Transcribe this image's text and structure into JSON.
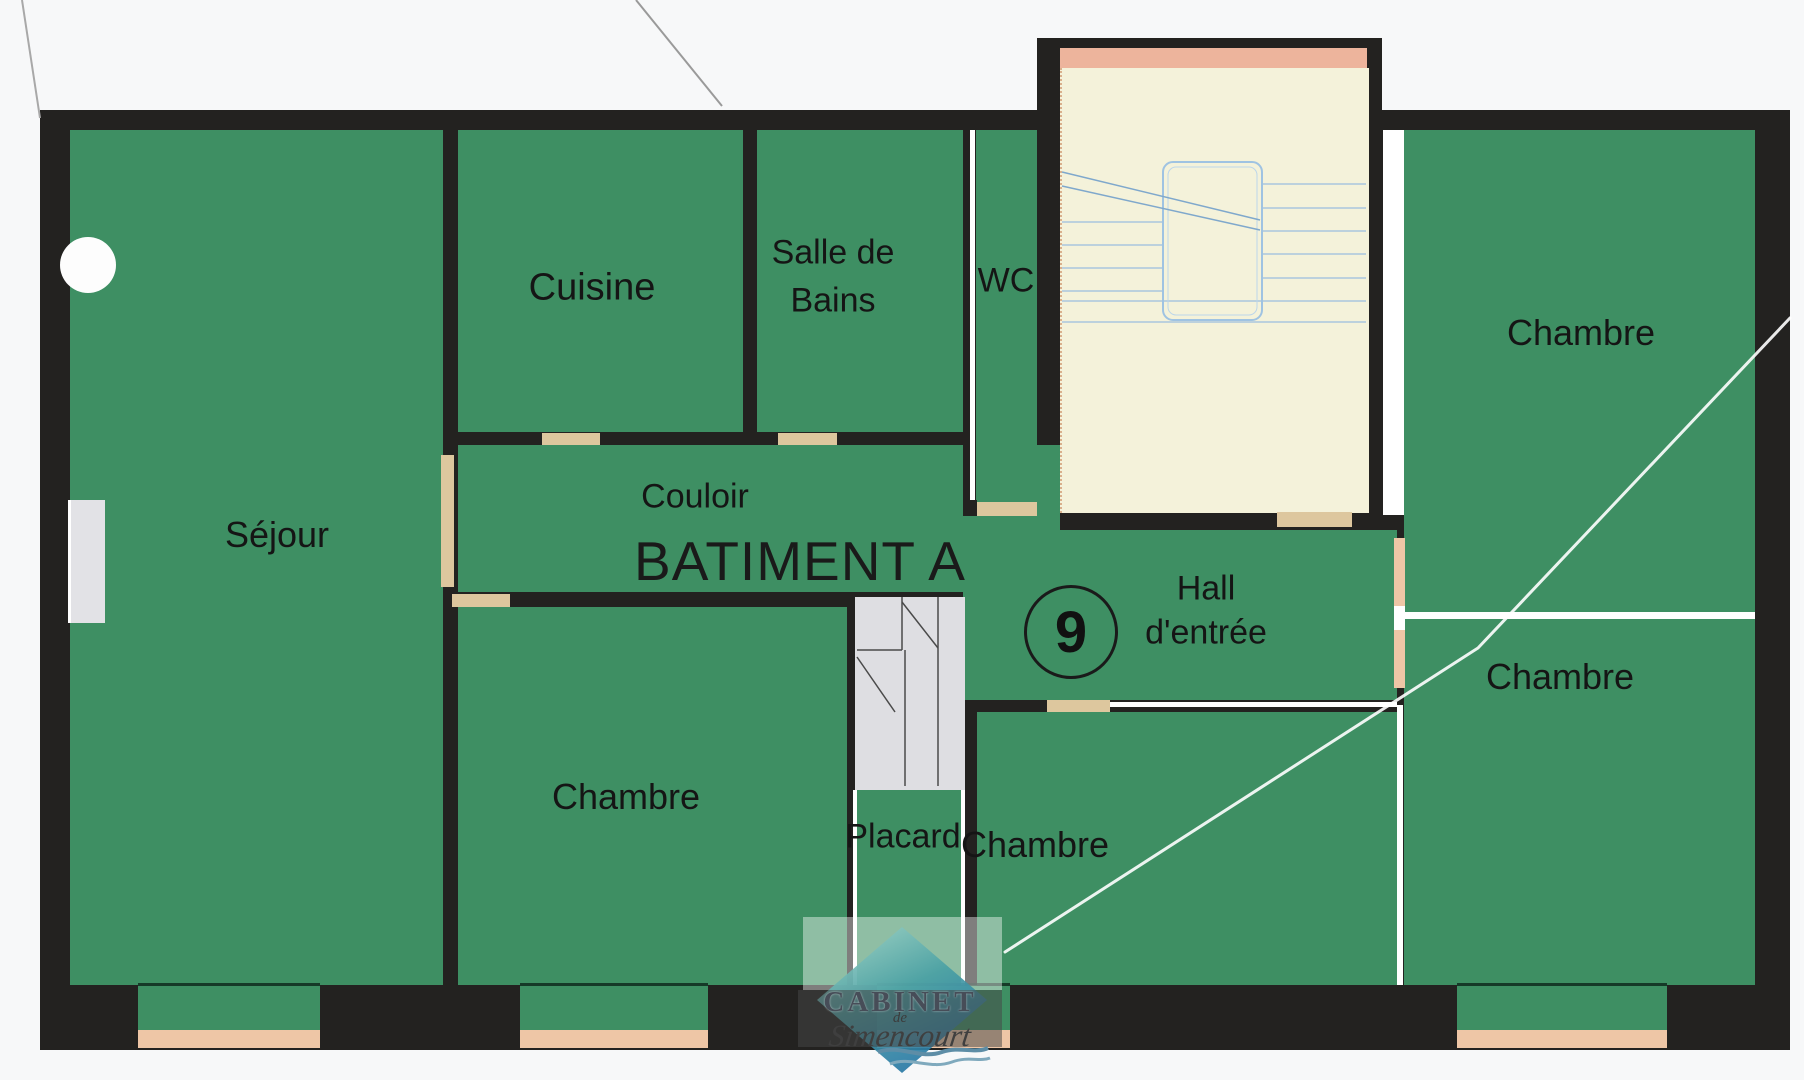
{
  "building": {
    "label": "BATIMENT A",
    "unit_number": "9"
  },
  "rooms": {
    "sejour": {
      "label": "Séjour"
    },
    "cuisine": {
      "label": "Cuisine"
    },
    "salle_de_bains": {
      "line1": "Salle de",
      "line2": "Bains"
    },
    "wc": {
      "label": "WC"
    },
    "couloir": {
      "label": "Couloir"
    },
    "hall": {
      "line1": "Hall",
      "line2": "d'entrée"
    },
    "placard": {
      "label": "Placard"
    },
    "chambre_bottom_left": {
      "label": "Chambre"
    },
    "chambre_bottom_center": {
      "label": "Chambre"
    },
    "chambre_top_right": {
      "label": "Chambre"
    },
    "chambre_mid_right": {
      "label": "Chambre"
    }
  },
  "logo": {
    "line1": "CABINET",
    "line2": "de",
    "line3": "Simencourt"
  },
  "colors": {
    "room_green": "#3e8f63",
    "wall_black": "#232220",
    "stair_cream": "#f4f2da",
    "stair_salmon": "#edb49c",
    "door_tan": "#ddc79e",
    "window_tan": "#eec6a6",
    "stair_line_blue": "#a9c6de",
    "logo_diamond_teal": "#49a0a4",
    "logo_diamond_blue": "#1e6ca6"
  }
}
